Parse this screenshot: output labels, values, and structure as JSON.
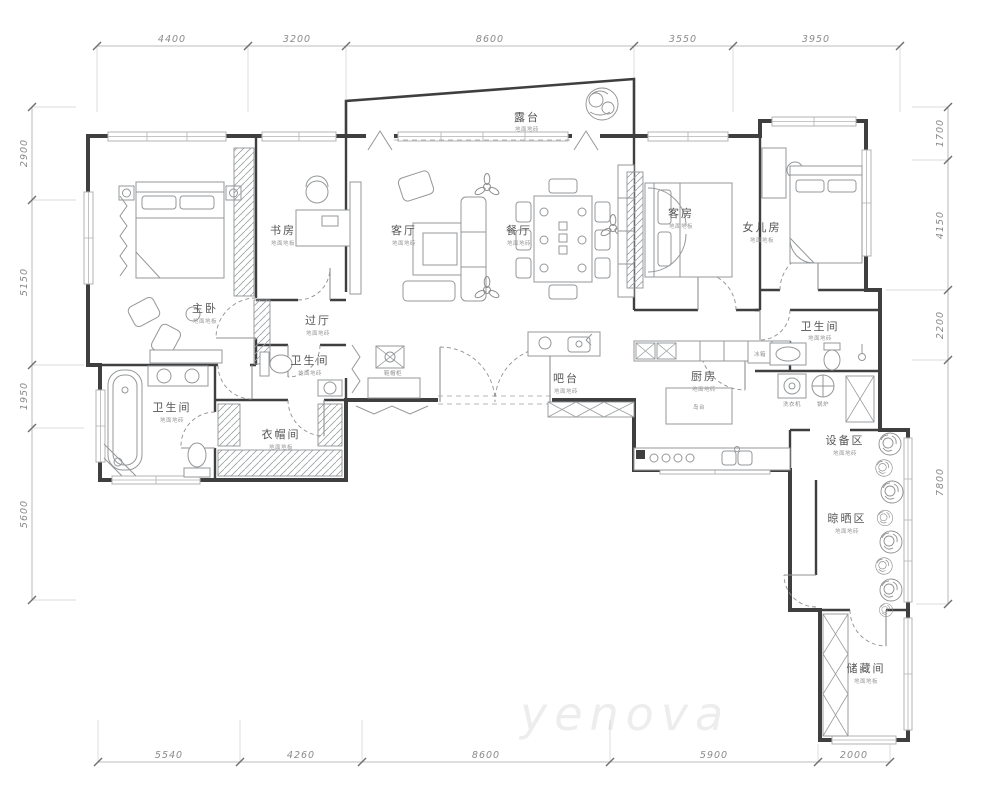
{
  "plan": {
    "watermark": "yenova"
  },
  "dimensions": {
    "top": [
      "4400",
      "3200",
      "8600",
      "3550",
      "3950"
    ],
    "bottom": [
      "5540",
      "4260",
      "8600",
      "5900",
      "2000"
    ],
    "left": [
      "2900",
      "5150",
      "1950",
      "5600"
    ],
    "right": [
      "1700",
      "4150",
      "2200",
      "7800"
    ]
  },
  "rooms": [
    {
      "name": "露台",
      "finish": "地面地砖"
    },
    {
      "name": "主卧",
      "finish": "地面地板"
    },
    {
      "name": "书房",
      "finish": "地面地板"
    },
    {
      "name": "客厅",
      "finish": "地面地砖"
    },
    {
      "name": "餐厅",
      "finish": "地面地砖"
    },
    {
      "name": "客房",
      "finish": "地面地板"
    },
    {
      "name": "女儿房",
      "finish": "地面地板"
    },
    {
      "name": "过厅",
      "finish": "地面地砖"
    },
    {
      "name": "卫生间",
      "finish": "地面地砖"
    },
    {
      "name": "卫生间",
      "finish": "地面地砖"
    },
    {
      "name": "衣帽间",
      "finish": "地面地板"
    },
    {
      "name": "吧台",
      "finish": "地面地砖"
    },
    {
      "name": "厨房",
      "finish": "地面地砖"
    },
    {
      "name": "卫生间",
      "finish": "地面地砖"
    },
    {
      "name": "设备区",
      "finish": "地面地砖"
    },
    {
      "name": "晾晒区",
      "finish": "地面地砖"
    },
    {
      "name": "储藏间",
      "finish": "地面地板"
    }
  ],
  "fixtures": {
    "shoe_cabinet": "鞋帽柜",
    "island": "岛台",
    "fridge": "冰箱",
    "washer": "洗衣机",
    "boiler": "锅炉"
  }
}
